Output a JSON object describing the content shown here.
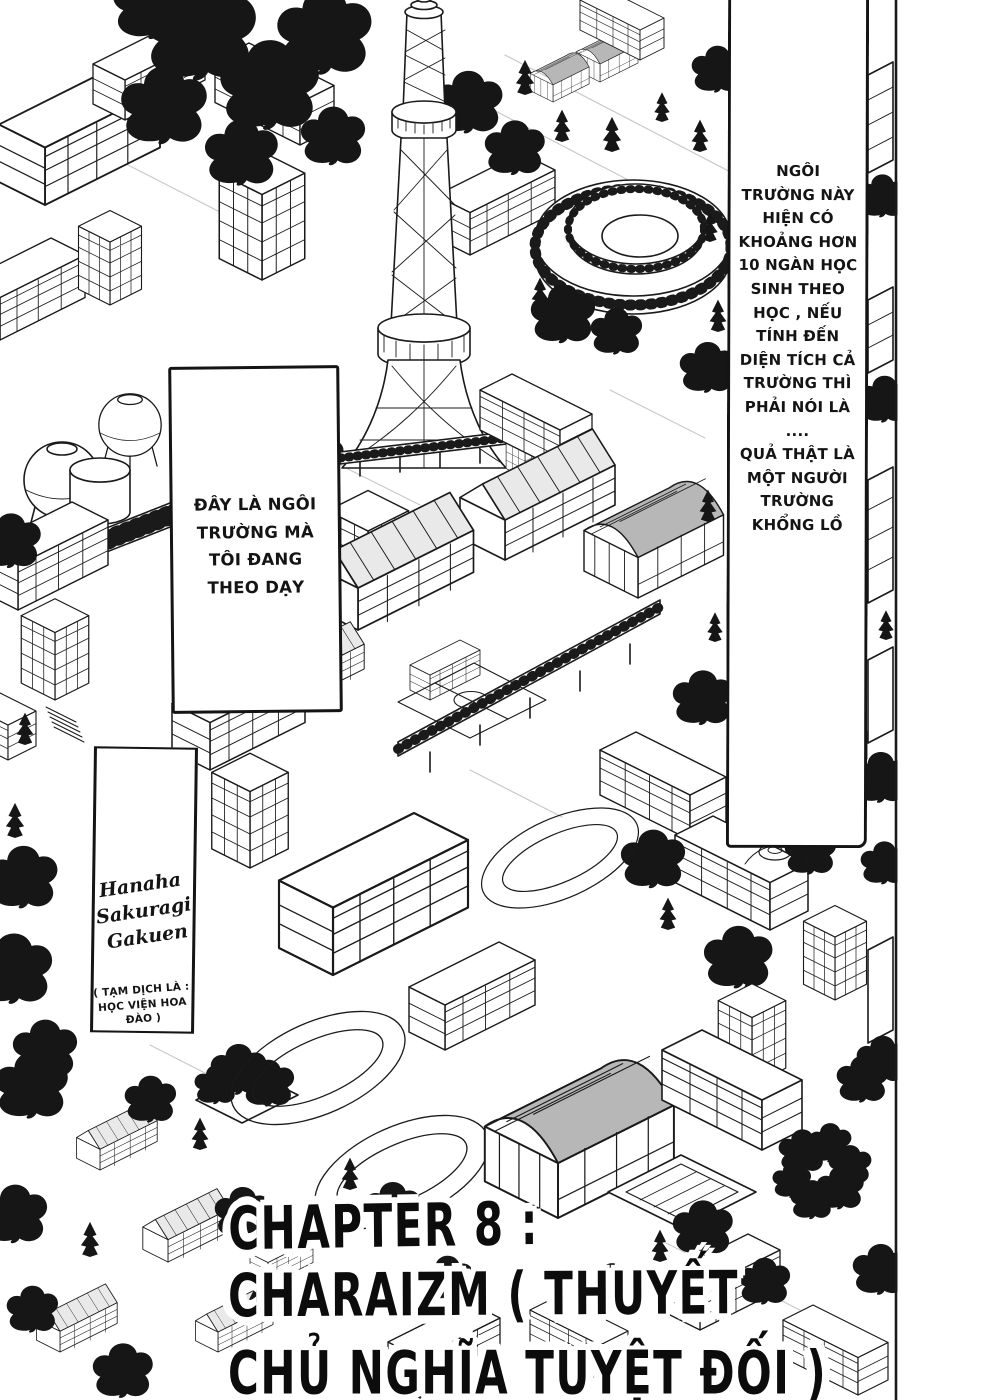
{
  "captions": {
    "narration_right": "NGÔI\nTRƯỜNG NÀY\nHIỆN CÓ\nKHOẢNG HƠN\n10 NGÀN HỌC\nSINH THEO\nHỌC , NẾU\nTÍNH ĐẾN\nDIỆN TÍCH CẢ\nTRƯỜNG THÌ\nPHẢI NÓI LÀ ....\nQUẢ THẬT LÀ\nMỘT NGƯỜI\nTRƯỜNG\nKHỔNG LỒ",
    "narration_middle": "ĐÂY LÀ NGÔI\nTRƯỜNG MÀ\nTÔI ĐANG\nTHEO DẠY",
    "school_name": "Hanaha\nSakuragi\nGakuen",
    "school_name_note": "( TẠM DỊCH LÀ :\nHỌC VIỆN HOA\nĐÀO )"
  },
  "chapter_title": {
    "line1": "CHAPTER 8 :",
    "line2": "CHARAIZM ( THUYẾT",
    "line3": "CHỦ NGHĨA TUYỆT ĐỐI )"
  },
  "colors": {
    "ink": "#141414",
    "paper": "#ffffff",
    "roof_gray": "#b7b7b7",
    "foliage": "#161616"
  }
}
